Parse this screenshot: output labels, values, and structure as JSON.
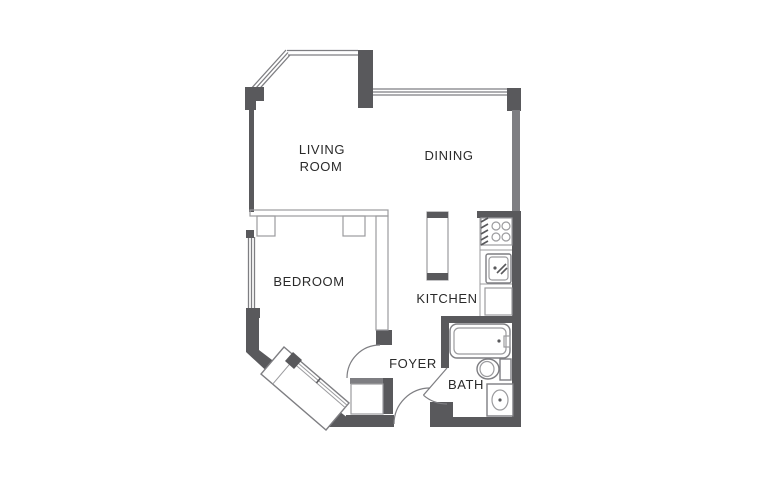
{
  "title": "Studio apartment floor plan",
  "colors": {
    "background": "#ffffff",
    "wall_dark": "#59595c",
    "wall_mid": "#7e7e82",
    "line": "#9b9b9e",
    "text": "#2a2a2a"
  },
  "rooms": {
    "living_room": {
      "label_line1": "LIVING",
      "label_line2": "ROOM"
    },
    "dining": {
      "label": "DINING"
    },
    "bedroom": {
      "label": "BEDROOM"
    },
    "kitchen": {
      "label": "KITCHEN"
    },
    "foyer": {
      "label": "FOYER"
    },
    "bath": {
      "label": "BATH"
    }
  },
  "fixtures": [
    "bay-window",
    "dining-window",
    "bedroom-window",
    "kitchen-island",
    "stove",
    "kitchen-sink",
    "kitchen-cabinet",
    "bathtub",
    "toilet",
    "vanity-sink",
    "sliding-door-closet",
    "foyer-closet",
    "entry-door",
    "bedroom-door",
    "bath-door"
  ]
}
